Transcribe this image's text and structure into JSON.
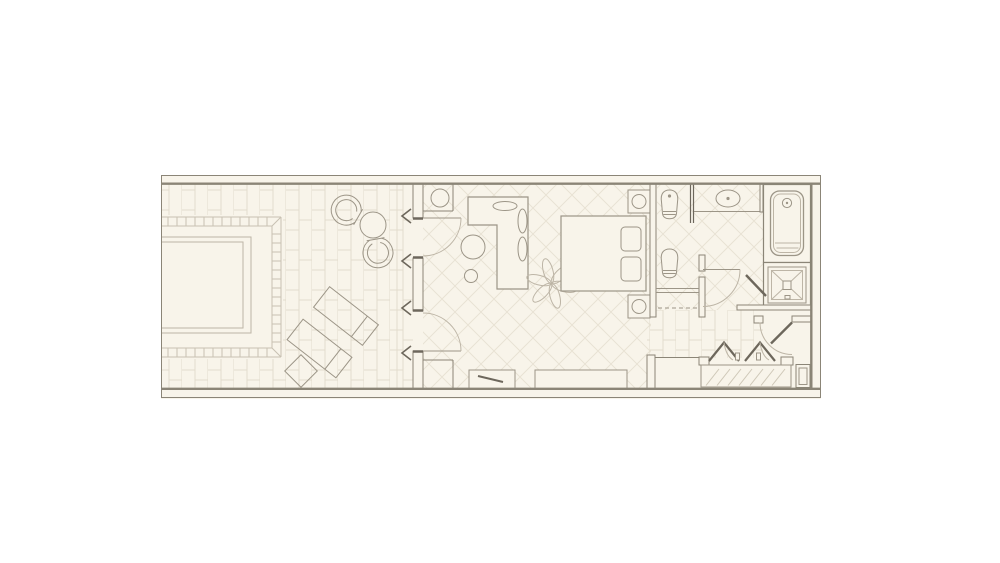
{
  "document": {
    "kind": "floor-plan-drawing",
    "visible_text": [],
    "canvas": {
      "width": 1000,
      "height": 563
    }
  },
  "palette": {
    "paper": "#ffffff",
    "cream": "#f8f4ea",
    "wall": "#8b8577",
    "wall_dark": "#6d675c",
    "furniture_line": "#9c9587",
    "fixture_light": "#bdb5a6",
    "brick_pattern": "#e2dccd",
    "diamond_pattern": "#e8e2d4",
    "pool_tile": "#c8c1b2",
    "closet_hatch": "#cfc8b8"
  },
  "legend": {
    "rooms": [
      {
        "name": "terrace",
        "floor": "brick-running-bond"
      },
      {
        "name": "plunge-pool",
        "floor": "tiled-coping"
      },
      {
        "name": "bedroom",
        "floor": "diamond-lattice"
      },
      {
        "name": "bathroom",
        "floor": "diamond-lattice"
      },
      {
        "name": "dressing-corridor",
        "floor": "brick-running-bond"
      },
      {
        "name": "entry-vestibule",
        "floor": "plain"
      }
    ],
    "fixtures": [
      "plunge-pool",
      "chaise-lounge",
      "chaise-lounge",
      "patio-side-table",
      "patio-chair",
      "patio-chair",
      "patio-round-table",
      "french-door",
      "french-door",
      "corner-round-table",
      "wet-bar-counter",
      "bar-stool",
      "ceiling-fan",
      "bed",
      "pillow",
      "pillow",
      "nightstand-with-lamp",
      "nightstand-with-lamp",
      "bench",
      "luggage-rack",
      "water-closet-toilet",
      "glass-partition",
      "vanity-sink",
      "bathtub",
      "shower",
      "shower-door",
      "toilet",
      "makeup-vanity-desk",
      "bathroom-door",
      "bifold-closet-doors",
      "closet-hanging-rail",
      "entry-door",
      "linen-closet",
      "service-shaft"
    ]
  }
}
